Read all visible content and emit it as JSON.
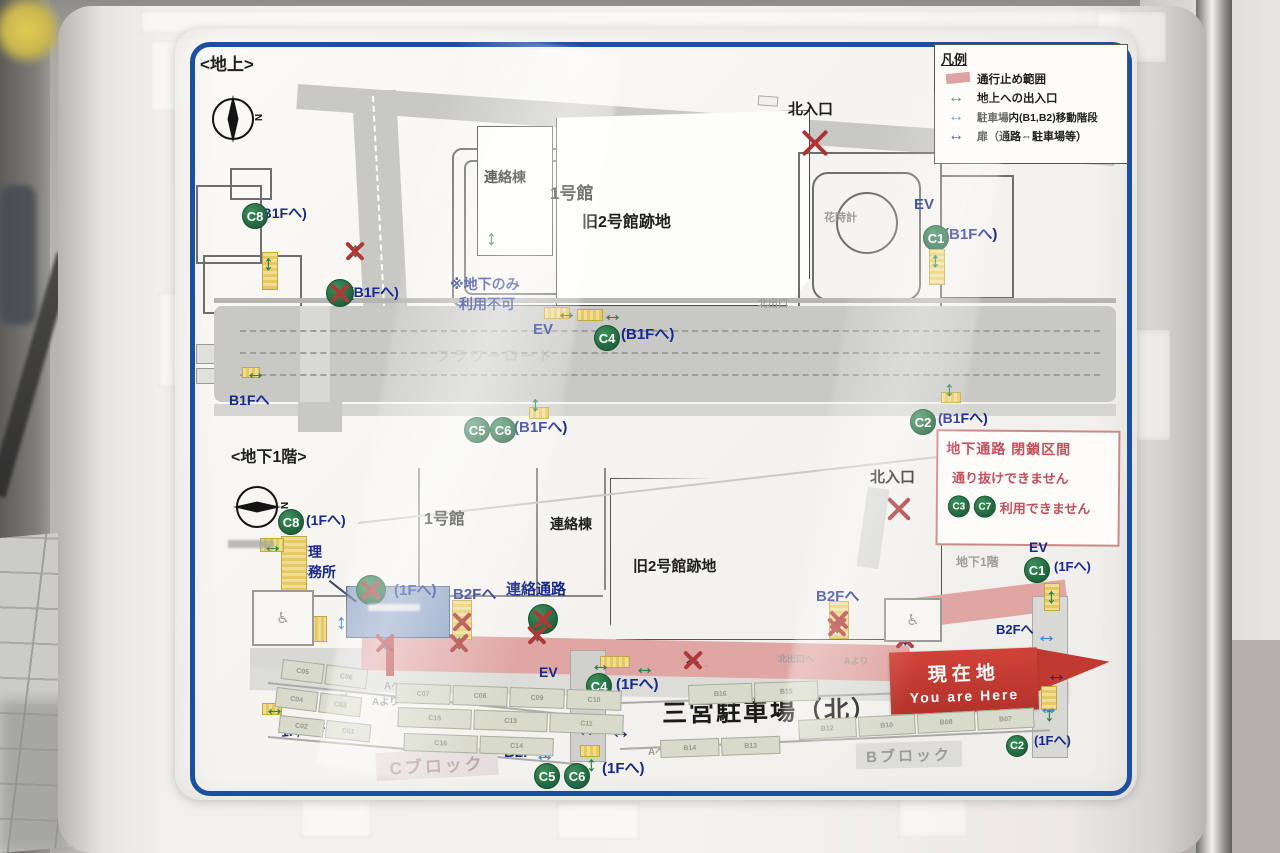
{
  "sign": {
    "upper": {
      "title": "<地上>",
      "compass_n": "N",
      "legend": {
        "title": "凡例",
        "items": [
          {
            "label": "通行止め範囲"
          },
          {
            "label": "地上への出入口"
          },
          {
            "label": "駐車場内(B1,B2)移動階段"
          },
          {
            "label": "扉（通路⇔駐車場等）"
          }
        ]
      }
    },
    "lower": {
      "title": "<地下1階>",
      "compass_n": "N",
      "notice": {
        "line1": "地下通路 閉鎖区間",
        "line2": "通り抜けできません",
        "badges": [
          "C3",
          "C7"
        ],
        "line3": "利用できません"
      },
      "banner": {
        "jp": "現在地",
        "en": "You are Here"
      },
      "parking_title": "三宮駐車場（北）",
      "block_c": "Cブロック",
      "block_b": "Bブロック"
    },
    "markers": [
      {
        "t": "label",
        "x": 200,
        "y": 56,
        "fs": 17,
        "c": "blk",
        "tx": "<地上>"
      },
      {
        "t": "label",
        "x": 550,
        "y": 185,
        "fs": 17,
        "c": "blk",
        "tx": "1号館"
      },
      {
        "t": "label",
        "x": 484,
        "y": 170,
        "fs": 14,
        "c": "blk",
        "tx": "連絡棟"
      },
      {
        "t": "label",
        "x": 582,
        "y": 214,
        "fs": 16,
        "c": "blk",
        "tx": "旧2号館跡地"
      },
      {
        "t": "label",
        "x": 788,
        "y": 102,
        "fs": 15,
        "c": "blk",
        "tx": "北入口"
      },
      {
        "t": "label",
        "x": 824,
        "y": 212,
        "fs": 11,
        "c": "faint",
        "tx": "花時計"
      },
      {
        "t": "label",
        "x": 758,
        "y": 299,
        "fs": 10,
        "c": "faint",
        "tx": "北出口"
      },
      {
        "t": "label",
        "x": 914,
        "y": 197,
        "fs": 15,
        "c": "navy",
        "tx": "EV"
      },
      {
        "t": "label",
        "x": 944,
        "y": 227,
        "fs": 15,
        "c": "navy",
        "tx": "(B1Fへ)"
      },
      {
        "t": "label",
        "x": 450,
        "y": 277,
        "fs": 14,
        "c": "navy",
        "tx": "※地下のみ"
      },
      {
        "t": "label",
        "x": 459,
        "y": 297,
        "fs": 14,
        "c": "navy",
        "tx": "利用不可"
      },
      {
        "t": "label",
        "x": 533,
        "y": 322,
        "fs": 15,
        "c": "navy",
        "tx": "EV"
      },
      {
        "t": "label",
        "x": 621,
        "y": 327,
        "fs": 15,
        "c": "navy",
        "tx": "(B1Fへ)"
      },
      {
        "t": "label",
        "x": 257,
        "y": 206,
        "fs": 14,
        "c": "navy",
        "tx": "(B1Fへ)"
      },
      {
        "t": "label",
        "x": 349,
        "y": 285,
        "fs": 14,
        "c": "navy",
        "tx": "(B1Fへ)"
      },
      {
        "t": "label",
        "x": 229,
        "y": 393,
        "fs": 14,
        "c": "navy",
        "tx": "B1Fへ"
      },
      {
        "t": "label",
        "x": 514,
        "y": 420,
        "fs": 15,
        "c": "navy",
        "tx": "(B1Fへ)"
      },
      {
        "t": "label",
        "x": 938,
        "y": 411,
        "fs": 14,
        "c": "navy",
        "tx": "(B1Fへ)"
      },
      {
        "t": "label",
        "x": 436,
        "y": 349,
        "fs": 14,
        "c": "road-t",
        "tx": "フラワーロード"
      },
      {
        "t": "badge",
        "x": 242,
        "y": 203,
        "tx": "C8"
      },
      {
        "t": "badge",
        "x": 923,
        "y": 225,
        "tx": "C1"
      },
      {
        "t": "badge",
        "x": 594,
        "y": 325,
        "tx": "C4"
      },
      {
        "t": "badge",
        "x": 464,
        "y": 417,
        "tx": "C5"
      },
      {
        "t": "badge",
        "x": 490,
        "y": 417,
        "tx": "C6"
      },
      {
        "t": "badge",
        "x": 910,
        "y": 409,
        "tx": "C2"
      },
      {
        "t": "badge",
        "x": 326,
        "y": 279,
        "tx": "",
        "cr": true,
        "s": 28
      },
      {
        "t": "stair",
        "x": 262,
        "y": 252,
        "w": 16,
        "h": 38
      },
      {
        "t": "stair",
        "x": 929,
        "y": 249,
        "w": 16,
        "h": 36
      },
      {
        "t": "stair",
        "x": 544,
        "y": 307,
        "w": 26,
        "h": 12
      },
      {
        "t": "stair",
        "x": 577,
        "y": 309,
        "w": 26,
        "h": 12
      },
      {
        "t": "stair",
        "x": 242,
        "y": 367,
        "w": 18,
        "h": 11
      },
      {
        "t": "stair",
        "x": 529,
        "y": 407,
        "w": 20,
        "h": 12
      },
      {
        "t": "stair",
        "x": 941,
        "y": 392,
        "w": 20,
        "h": 11
      },
      {
        "t": "arrow",
        "x": 263,
        "y": 253,
        "d": "v",
        "k": "g"
      },
      {
        "t": "arrow",
        "x": 350,
        "y": 240,
        "d": "v",
        "k": "g",
        "cr": true
      },
      {
        "t": "arrow",
        "x": 486,
        "y": 228,
        "d": "v",
        "k": "g"
      },
      {
        "t": "arrow",
        "x": 930,
        "y": 250,
        "d": "v",
        "k": "g"
      },
      {
        "t": "arrow",
        "x": 556,
        "y": 302,
        "d": "h",
        "k": "g"
      },
      {
        "t": "arrow",
        "x": 602,
        "y": 304,
        "d": "h",
        "k": "g"
      },
      {
        "t": "arrow",
        "x": 245,
        "y": 362,
        "d": "h",
        "k": "g"
      },
      {
        "t": "arrow",
        "x": 530,
        "y": 394,
        "d": "v",
        "k": "g"
      },
      {
        "t": "arrow",
        "x": 944,
        "y": 379,
        "d": "v",
        "k": "g"
      },
      {
        "t": "redx",
        "x": 798,
        "y": 126,
        "s": 34
      },
      {
        "t": "label",
        "x": 231,
        "y": 449,
        "fs": 16,
        "c": "blk",
        "tx": "<地下1階>"
      },
      {
        "t": "label",
        "x": 424,
        "y": 511,
        "fs": 16,
        "c": "blk",
        "tx": "1号館"
      },
      {
        "t": "label",
        "x": 550,
        "y": 517,
        "fs": 14,
        "c": "blk",
        "tx": "連絡棟"
      },
      {
        "t": "label",
        "x": 633,
        "y": 559,
        "fs": 15,
        "c": "blk",
        "tx": "旧2号館跡地"
      },
      {
        "t": "label",
        "x": 870,
        "y": 470,
        "fs": 15,
        "c": "blk",
        "tx": "北入口"
      },
      {
        "t": "label",
        "x": 956,
        "y": 556,
        "fs": 12,
        "c": "faint",
        "tx": "地下1階"
      },
      {
        "t": "label",
        "x": 1029,
        "y": 540,
        "fs": 14,
        "c": "navy",
        "tx": "EV"
      },
      {
        "t": "label",
        "x": 1054,
        "y": 560,
        "fs": 13,
        "c": "navy",
        "tx": "(1Fへ)"
      },
      {
        "t": "label",
        "x": 306,
        "y": 513,
        "fs": 14,
        "c": "navy",
        "tx": "(1Fへ)"
      },
      {
        "t": "label",
        "x": 294,
        "y": 545,
        "fs": 14,
        "c": "navy",
        "tx": "管理"
      },
      {
        "t": "label",
        "x": 294,
        "y": 565,
        "fs": 14,
        "c": "navy",
        "tx": "事務所"
      },
      {
        "t": "label",
        "x": 394,
        "y": 583,
        "fs": 15,
        "c": "navy",
        "tx": "(1Fへ)"
      },
      {
        "t": "label",
        "x": 453,
        "y": 587,
        "fs": 15,
        "c": "navy",
        "tx": "B2Fへ"
      },
      {
        "t": "label",
        "x": 506,
        "y": 582,
        "fs": 15,
        "c": "navy",
        "tx": "連絡通路"
      },
      {
        "t": "label",
        "x": 816,
        "y": 589,
        "fs": 15,
        "c": "navy",
        "tx": "B2Fへ"
      },
      {
        "t": "label",
        "x": 996,
        "y": 623,
        "fs": 13,
        "c": "navy",
        "tx": "B2Fへ"
      },
      {
        "t": "label",
        "x": 992,
        "y": 707,
        "fs": 13,
        "c": "navy",
        "tx": "B2Fへ"
      },
      {
        "t": "label",
        "x": 1034,
        "y": 734,
        "fs": 13,
        "c": "navy",
        "tx": "(1Fへ)"
      },
      {
        "t": "label",
        "x": 539,
        "y": 665,
        "fs": 14,
        "c": "navy",
        "tx": "EV"
      },
      {
        "t": "label",
        "x": 616,
        "y": 677,
        "fs": 15,
        "c": "navy",
        "tx": "(1Fへ)"
      },
      {
        "t": "label",
        "x": 280,
        "y": 725,
        "fs": 14,
        "c": "navy",
        "tx": "1F,B2Fへ",
        "rot": -6
      },
      {
        "t": "label",
        "x": 504,
        "y": 745,
        "fs": 15,
        "c": "navy",
        "tx": "B2Fへ"
      },
      {
        "t": "label",
        "x": 602,
        "y": 761,
        "fs": 15,
        "c": "navy",
        "tx": "(1Fへ)"
      },
      {
        "t": "label",
        "x": 384,
        "y": 681,
        "fs": 10,
        "c": "faint",
        "tx": "Aへ"
      },
      {
        "t": "label",
        "x": 372,
        "y": 697,
        "fs": 10,
        "c": "faint",
        "tx": "Aより"
      },
      {
        "t": "label",
        "x": 648,
        "y": 747,
        "fs": 10,
        "c": "faint",
        "tx": "Aへ"
      },
      {
        "t": "label",
        "x": 778,
        "y": 655,
        "fs": 9,
        "c": "faint",
        "tx": "北出口へ"
      },
      {
        "t": "label",
        "x": 844,
        "y": 657,
        "fs": 9,
        "c": "faint",
        "tx": "Aより"
      },
      {
        "t": "label",
        "x": 598,
        "y": 710,
        "fs": 13,
        "c": "faint",
        "tx": "←"
      },
      {
        "t": "label",
        "x": 860,
        "y": 724,
        "fs": 13,
        "c": "faint",
        "tx": "←"
      },
      {
        "t": "label",
        "x": 338,
        "y": 686,
        "fs": 12,
        "c": "faint",
        "tx": "→"
      },
      {
        "t": "label",
        "x": 700,
        "y": 660,
        "fs": 10,
        "c": "faint",
        "tx": "→"
      },
      {
        "t": "badge",
        "x": 278,
        "y": 509,
        "tx": "C8"
      },
      {
        "t": "badge",
        "x": 1024,
        "y": 557,
        "tx": "C1"
      },
      {
        "t": "badge",
        "x": 586,
        "y": 673,
        "tx": "C4"
      },
      {
        "t": "badge",
        "x": 534,
        "y": 763,
        "tx": "C5"
      },
      {
        "t": "badge",
        "x": 564,
        "y": 763,
        "tx": "C6"
      },
      {
        "t": "badge",
        "x": 1006,
        "y": 735,
        "tx": "C2",
        "s": 22
      },
      {
        "t": "badge",
        "x": 356,
        "y": 575,
        "tx": "",
        "cr": true,
        "s": 30
      },
      {
        "t": "badge",
        "x": 528,
        "y": 604,
        "tx": "",
        "cr": true,
        "s": 30
      },
      {
        "t": "stair",
        "x": 281,
        "y": 536,
        "w": 26,
        "h": 92
      },
      {
        "t": "stair",
        "x": 281,
        "y": 616,
        "w": 46,
        "h": 26
      },
      {
        "t": "stair",
        "x": 260,
        "y": 538,
        "w": 24,
        "h": 14
      },
      {
        "t": "stair",
        "x": 452,
        "y": 600,
        "w": 20,
        "h": 40
      },
      {
        "t": "stair",
        "x": 829,
        "y": 601,
        "w": 20,
        "h": 38
      },
      {
        "t": "stair",
        "x": 600,
        "y": 656,
        "w": 30,
        "h": 12
      },
      {
        "t": "stair",
        "x": 580,
        "y": 745,
        "w": 20,
        "h": 12
      },
      {
        "t": "stair",
        "x": 262,
        "y": 703,
        "w": 20,
        "h": 12
      },
      {
        "t": "stair",
        "x": 1044,
        "y": 583,
        "w": 16,
        "h": 28
      },
      {
        "t": "stair",
        "x": 1041,
        "y": 686,
        "w": 16,
        "h": 24
      },
      {
        "t": "arrow",
        "x": 262,
        "y": 535,
        "d": "h",
        "k": "g"
      },
      {
        "t": "arrow",
        "x": 454,
        "y": 632,
        "d": "v",
        "k": "g",
        "cr": true
      },
      {
        "t": "arrow",
        "x": 832,
        "y": 616,
        "d": "v",
        "k": "g",
        "cr": true
      },
      {
        "t": "arrow",
        "x": 532,
        "y": 624,
        "d": "v",
        "k": "g",
        "cr": true
      },
      {
        "t": "arrow",
        "x": 590,
        "y": 654,
        "d": "h",
        "k": "g"
      },
      {
        "t": "arrow",
        "x": 634,
        "y": 657,
        "d": "h",
        "k": "g"
      },
      {
        "t": "arrow",
        "x": 586,
        "y": 754,
        "d": "v",
        "k": "g"
      },
      {
        "t": "arrow",
        "x": 264,
        "y": 698,
        "d": "h",
        "k": "g"
      },
      {
        "t": "arrow",
        "x": 1046,
        "y": 586,
        "d": "v",
        "k": "g"
      },
      {
        "t": "arrow",
        "x": 1044,
        "y": 704,
        "d": "v",
        "k": "g"
      },
      {
        "t": "arrow",
        "x": 336,
        "y": 612,
        "d": "v",
        "k": "b"
      },
      {
        "t": "arrow",
        "x": 270,
        "y": 627,
        "d": "v",
        "k": "b"
      },
      {
        "t": "arrow",
        "x": 534,
        "y": 744,
        "d": "h",
        "k": "b"
      },
      {
        "t": "arrow",
        "x": 1036,
        "y": 625,
        "d": "h",
        "k": "b"
      },
      {
        "t": "arrow",
        "x": 1038,
        "y": 697,
        "d": "h",
        "k": "b"
      },
      {
        "t": "arrow",
        "x": 380,
        "y": 632,
        "d": "v",
        "k": "b",
        "cr": true
      },
      {
        "t": "arrow",
        "x": 576,
        "y": 719,
        "d": "h",
        "k": "n"
      },
      {
        "t": "arrow",
        "x": 610,
        "y": 721,
        "d": "h",
        "k": "n"
      },
      {
        "t": "arrow",
        "x": 682,
        "y": 649,
        "d": "h",
        "k": "n",
        "cr": true
      },
      {
        "t": "arrow",
        "x": 1046,
        "y": 664,
        "d": "h",
        "k": "n"
      },
      {
        "t": "arrow",
        "x": 900,
        "y": 628,
        "d": "v",
        "k": "n",
        "cr": true
      },
      {
        "t": "redx",
        "x": 884,
        "y": 494,
        "s": 30
      },
      {
        "t": "redx",
        "x": 450,
        "y": 610,
        "s": 24
      },
      {
        "t": "redx",
        "x": 827,
        "y": 608,
        "s": 24
      },
      {
        "t": "stalls",
        "x": 283,
        "y": 659,
        "w": 86,
        "h": 20,
        "rot": 7,
        "cells": [
          "C05",
          "C06"
        ]
      },
      {
        "t": "stalls",
        "x": 277,
        "y": 687,
        "w": 86,
        "h": 20,
        "rot": 7,
        "cells": [
          "C04",
          "C03"
        ]
      },
      {
        "t": "stalls",
        "x": 280,
        "y": 715,
        "w": 92,
        "h": 18,
        "rot": 6,
        "cells": [
          "C02",
          "C01"
        ]
      },
      {
        "t": "stalls",
        "x": 396,
        "y": 683,
        "w": 226,
        "h": 20,
        "rot": 2,
        "cells": [
          "C07",
          "C08",
          "C09",
          "C10"
        ]
      },
      {
        "t": "stalls",
        "x": 398,
        "y": 707,
        "w": 226,
        "h": 20,
        "rot": 2,
        "cells": [
          "C15",
          "C13",
          "C11"
        ]
      },
      {
        "t": "stalls",
        "x": 404,
        "y": 733,
        "w": 150,
        "h": 18,
        "rot": 2,
        "cells": [
          "C16",
          "C14"
        ]
      },
      {
        "t": "stalls",
        "x": 688,
        "y": 685,
        "w": 130,
        "h": 20,
        "rot": -2,
        "cells": [
          "B16",
          "B15"
        ]
      },
      {
        "t": "stalls",
        "x": 798,
        "y": 720,
        "w": 236,
        "h": 20,
        "rot": -3,
        "cells": [
          "B12",
          "B10",
          "B08",
          "B07"
        ]
      },
      {
        "t": "stalls",
        "x": 660,
        "y": 740,
        "w": 120,
        "h": 18,
        "rot": -2,
        "cells": [
          "B14",
          "B13"
        ]
      },
      {
        "t": "micro",
        "x": 228,
        "y": 540,
        "w": 46,
        "h": 8
      },
      {
        "t": "micro",
        "x": 368,
        "y": 604,
        "w": 52,
        "h": 7,
        "light": true
      },
      {
        "t": "line",
        "x": 330,
        "y": 580,
        "w": 34,
        "rot": 38
      },
      {
        "t": "wc",
        "x": 252,
        "y": 590,
        "w": 62,
        "h": 56
      },
      {
        "t": "wc",
        "x": 884,
        "y": 598,
        "w": 58,
        "h": 44
      }
    ]
  }
}
